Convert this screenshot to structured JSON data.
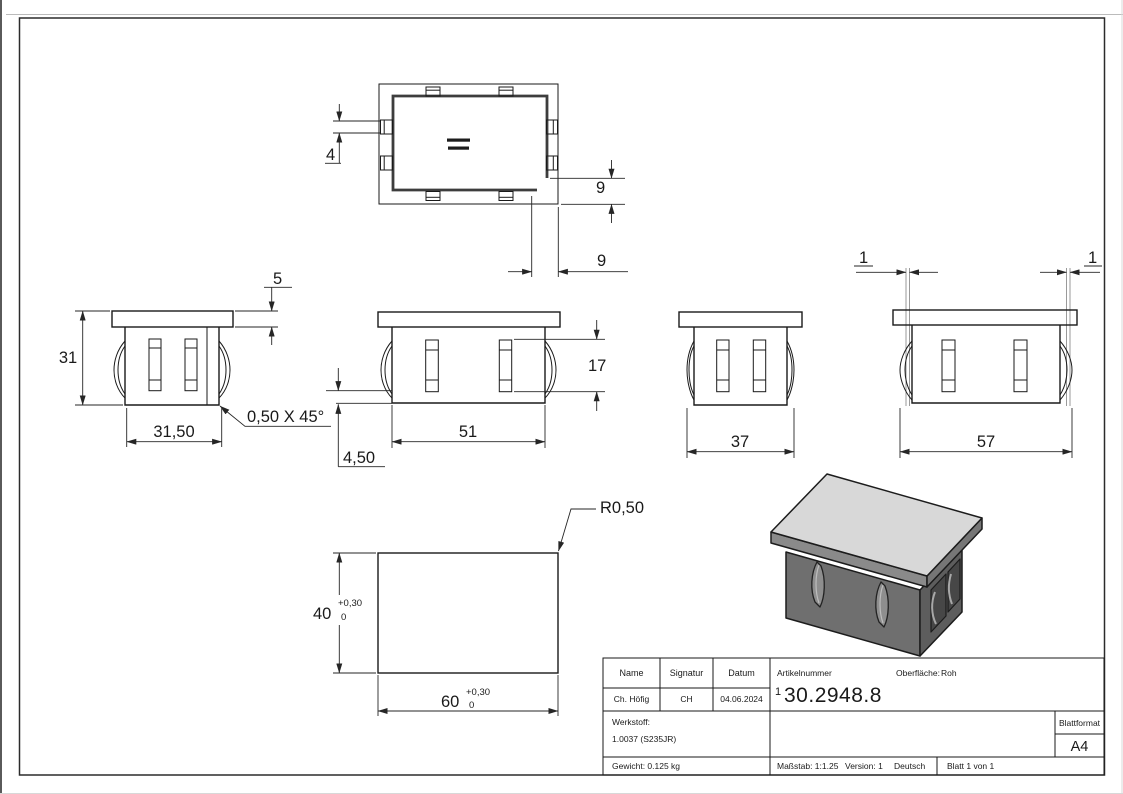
{
  "drawing": {
    "top_view": {
      "dim_tab_width": "4",
      "dim_inset_side": "9",
      "dim_inset_bottom": "9"
    },
    "front_view": {
      "dim_flange_height": "5",
      "dim_total_height": "31",
      "dim_body_width": "31,50",
      "chamfer_note": "0,50 X 45°"
    },
    "long_side_view": {
      "dim_slot_height": "17",
      "dim_body_length": "51",
      "dim_clip_offset": "4,50"
    },
    "short_side_view": {
      "dim_clip_span": "37"
    },
    "wide_side_view": {
      "dim_wall_left": "1",
      "dim_wall_right": "1",
      "dim_clip_span": "57"
    },
    "outline_view": {
      "dim_height": "40",
      "dim_height_tol_upper": "+0,30",
      "dim_height_tol_lower": "0",
      "dim_width": "60",
      "dim_width_tol_upper": "+0,30",
      "dim_width_tol_lower": "0",
      "corner_radius": "R0,50"
    }
  },
  "title_block": {
    "headers": {
      "name": "Name",
      "signatur": "Signatur",
      "datum": "Datum",
      "artikelnummer": "Artikelnummer",
      "oberflaeche": "Oberfläche:",
      "werkstoff": "Werkstoff:",
      "blattformat": "Blattformat"
    },
    "values": {
      "name": "Ch. Höfig",
      "signatur": "CH",
      "datum": "04.06.2024",
      "artikelnummer_prefix": "1",
      "artikelnummer": "30.2948.8",
      "oberflaeche": "Roh",
      "werkstoff": "1.0037 (S235JR)",
      "gewicht": "Gewicht: 0.125 kg",
      "massstab": "Maßstab: 1:1.25",
      "version": "Version: 1",
      "sprache": "Deutsch",
      "blatt": "Blatt 1 von 1",
      "blattformat": "A4"
    }
  }
}
